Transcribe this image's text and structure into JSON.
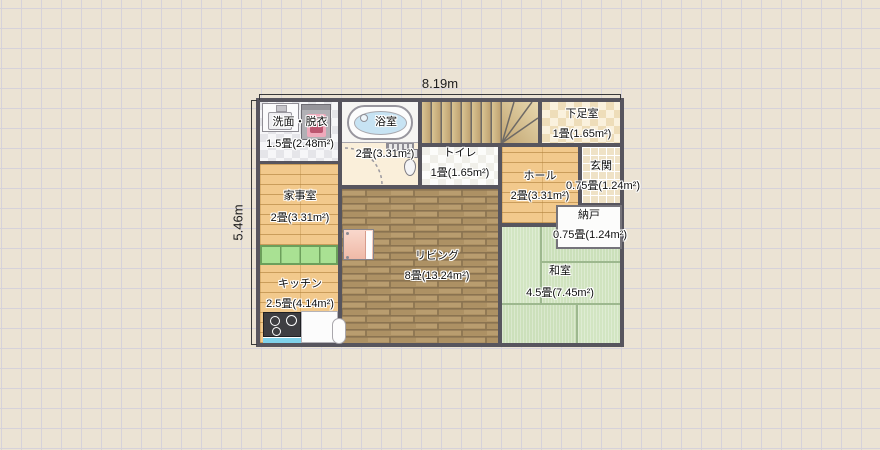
{
  "app": {
    "view": "floor-plan-canvas"
  },
  "dimension_labels": {
    "width": "8.19m",
    "height": "5.46m"
  },
  "rooms": {
    "senmen": {
      "name": "洗面・脱衣",
      "size": "1.5畳(2.48m²)"
    },
    "bath": {
      "name": "浴室",
      "size": "2畳(3.31m²)"
    },
    "toilet": {
      "name": "トイレ",
      "size": "1畳(1.65m²)"
    },
    "shoe": {
      "name": "下足室",
      "size": "1畳(1.65m²)"
    },
    "hall": {
      "name": "ホール",
      "size": "2畳(3.31m²)"
    },
    "genkan": {
      "name": "玄関",
      "size": "0.75畳(1.24m²)"
    },
    "nando": {
      "name": "納戸",
      "size": "0.75畳(1.24m²)"
    },
    "kaji": {
      "name": "家事室",
      "size": "2畳(3.31m²)"
    },
    "kitchen": {
      "name": "キッチン",
      "size": "2.5畳(4.14m²)"
    },
    "living": {
      "name": "リビング",
      "size": "8畳(13.24m²)"
    },
    "washitsu": {
      "name": "和室",
      "size": "4.5畳(7.45m²)"
    }
  },
  "fixtures": [
    "washbasin",
    "washing-machine",
    "bathtub",
    "bath-folding-door",
    "door-swing",
    "toilet-bowl",
    "staircase",
    "green-cabinet-counter",
    "gas-stove",
    "kitchen-counter",
    "kitchen-sink",
    "piano-cabinet"
  ],
  "colors": {
    "canvas_bg": "#EBE3D4",
    "grid_line": "#D6D2DA",
    "wall": "#57555E",
    "wood_light": "#F2C98C",
    "wood_living": "#AD9164",
    "tatami": "#CFE3C0",
    "counter_green": "#A9E193",
    "bath_water": "#C7E3F3",
    "washer_pink": "#EFA9BB",
    "stove_blue": "#7FD2EB"
  }
}
